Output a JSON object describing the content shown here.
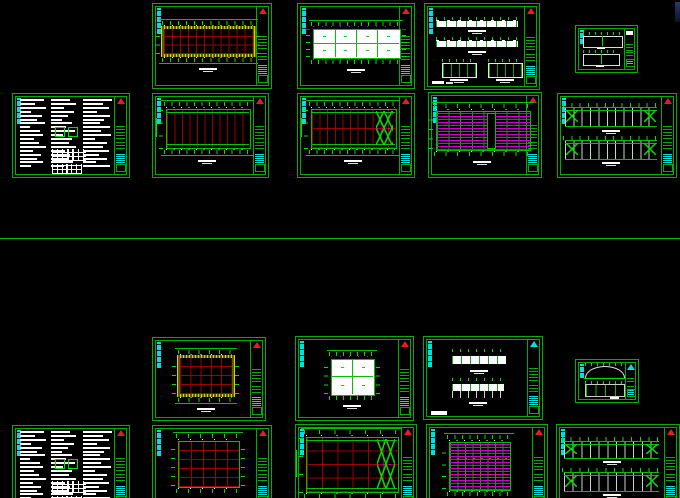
{
  "app": {
    "name": "cad-model-space",
    "viewport": {
      "width": 680,
      "height": 498
    }
  },
  "colors": {
    "background": "#000000",
    "frame_green": "#00ae00",
    "bright_green": "#00e000",
    "line_green": "#00c000",
    "red_grid": "#9c0000",
    "red_accent": "#ff3030",
    "triangle_red": "#e02020",
    "yellow_hatch_light": "#d8d800",
    "yellow_hatch_dark": "#5c5c00",
    "magenta": "#cc00cc",
    "cyan": "#00e0e0",
    "white": "#ffffff",
    "gray_column": "#d0d0d0",
    "separator_green": "#00bb00"
  },
  "separator_line": {
    "y": 238
  },
  "corner_sliver": {
    "x": 675,
    "y": 2,
    "w": 5,
    "h": 20
  },
  "notes": {
    "columns": [
      {
        "x": 6,
        "w": 24,
        "lines": [
          88,
          55,
          95,
          40,
          78,
          62,
          90,
          35,
          72,
          84,
          50,
          68,
          92,
          45,
          76,
          60,
          83,
          38
        ]
      },
      {
        "x": 33,
        "w": 24,
        "lines": [
          70,
          90,
          45,
          82,
          60,
          38,
          74,
          55,
          88,
          42,
          76,
          64,
          90,
          50,
          70,
          58,
          80,
          46
        ]
      },
      {
        "x": 60,
        "w": 26,
        "lines": [
          95,
          65,
          85,
          45,
          90,
          70,
          55,
          88,
          60,
          92,
          40,
          78,
          66,
          85,
          52,
          80,
          44,
          90
        ]
      }
    ]
  },
  "sheets": [
    {
      "id": "sheet-01",
      "type": "plan_hatched",
      "x": 152,
      "y": 3,
      "w": 118,
      "h": 84,
      "tri": "red",
      "d": {
        "l": 9,
        "r": 84,
        "t": 30,
        "b": 60
      },
      "vlines": 10,
      "hlines": 2
    },
    {
      "id": "sheet-02",
      "type": "plan_panels",
      "x": 297,
      "y": 3,
      "w": 116,
      "h": 84,
      "tri": "red",
      "d": {
        "l": 13,
        "r": 87,
        "t": 30,
        "b": 63
      },
      "pcols": 4,
      "prows": 2
    },
    {
      "id": "sheet-03",
      "type": "elevations_four",
      "x": 424,
      "y": 3,
      "w": 114,
      "h": 85,
      "tri": "red"
    },
    {
      "id": "sheet-04",
      "type": "small_sections",
      "x": 575,
      "y": 25,
      "w": 61,
      "h": 46,
      "tri": "none"
    },
    {
      "id": "sheet-05",
      "type": "notes",
      "x": 12,
      "y": 93,
      "w": 116,
      "h": 83,
      "tri": "red"
    },
    {
      "id": "sheet-06",
      "type": "plan_columns",
      "x": 152,
      "y": 93,
      "w": 115,
      "h": 83,
      "tri": "red",
      "d": {
        "l": 11,
        "r": 83,
        "t": 18,
        "b": 64
      },
      "vlines": 11,
      "braced": false,
      "hrows": 0
    },
    {
      "id": "sheet-07",
      "type": "plan_columns",
      "x": 297,
      "y": 93,
      "w": 116,
      "h": 83,
      "tri": "red",
      "d": {
        "l": 11,
        "r": 83,
        "t": 18,
        "b": 64
      },
      "vlines": 11,
      "braced": true,
      "hrows": 2
    },
    {
      "id": "sheet-08",
      "type": "purlin_plan",
      "x": 428,
      "y": 92,
      "w": 112,
      "h": 84,
      "tri": "red",
      "d": {
        "l": 6,
        "r": 89,
        "t": 22,
        "b": 67
      },
      "opening": true
    },
    {
      "id": "sheet-09",
      "type": "bracing_elev",
      "x": 557,
      "y": 93,
      "w": 118,
      "h": 83,
      "tri": "red",
      "strips": [
        {
          "t": 16,
          "b": 38
        },
        {
          "t": 55,
          "b": 77
        }
      ]
    },
    {
      "id": "sheet-10",
      "type": "plan_hatched",
      "x": 152,
      "y": 337,
      "w": 112,
      "h": 82,
      "tri": "red",
      "d": {
        "l": 24,
        "r": 70,
        "t": 24,
        "b": 68
      },
      "vlines": 4,
      "hlines": 3
    },
    {
      "id": "sheet-11",
      "type": "plan_panels",
      "x": 295,
      "y": 336,
      "w": 117,
      "h": 83,
      "tri": "red",
      "d": {
        "l": 30,
        "r": 66,
        "t": 26,
        "b": 68
      },
      "pcols": 2,
      "prows": 2
    },
    {
      "id": "sheet-12",
      "type": "elevations_two",
      "x": 423,
      "y": 336,
      "w": 118,
      "h": 82,
      "tri": "cyan"
    },
    {
      "id": "sheet-13",
      "type": "small_sections2",
      "x": 575,
      "y": 359,
      "w": 62,
      "h": 42,
      "tri": "cyan"
    },
    {
      "id": "sheet-14",
      "type": "notes",
      "x": 12,
      "y": 425,
      "w": 116,
      "h": 83,
      "tri": "red"
    },
    {
      "id": "sheet-15",
      "type": "plan_grid",
      "x": 152,
      "y": 425,
      "w": 118,
      "h": 83,
      "tri": "red",
      "d": {
        "l": 21,
        "r": 72,
        "t": 18,
        "b": 72
      },
      "vlines": 4,
      "hlines": 4
    },
    {
      "id": "sheet-16",
      "type": "plan_columns",
      "x": 295,
      "y": 424,
      "w": 120,
      "h": 84,
      "tri": "red",
      "d": {
        "l": 8,
        "r": 84,
        "t": 14,
        "b": 78
      },
      "vlines": 6,
      "braced": true,
      "hrows": 4
    },
    {
      "id": "sheet-17",
      "type": "purlin_plan",
      "x": 426,
      "y": 424,
      "w": 120,
      "h": 84,
      "tri": "red",
      "d": {
        "l": 18,
        "r": 68,
        "t": 20,
        "b": 76
      },
      "opening": false
    },
    {
      "id": "sheet-18",
      "type": "bracing_elev",
      "x": 556,
      "y": 424,
      "w": 122,
      "h": 84,
      "tri": "red",
      "strips": [
        {
          "t": 19,
          "b": 38
        },
        {
          "t": 56,
          "b": 77
        }
      ]
    }
  ]
}
